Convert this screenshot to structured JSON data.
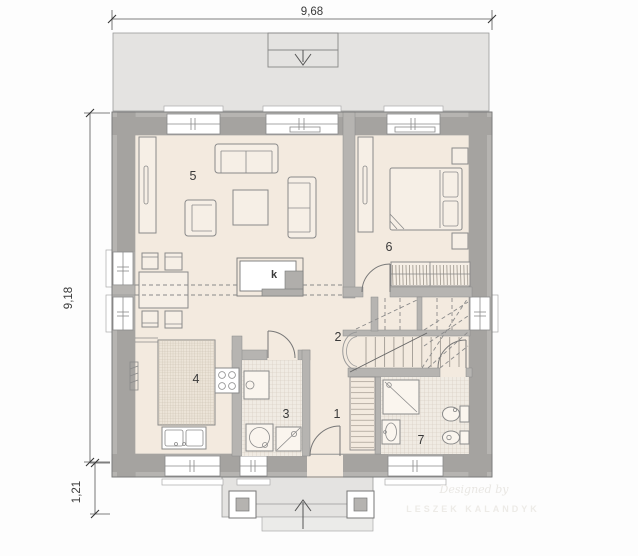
{
  "dimensions": {
    "top": "9,68",
    "left": "9,18",
    "porch_depth": "1,21"
  },
  "room_labels": {
    "hall": "1",
    "stairs": "2",
    "utility": "3",
    "kitchen": "4",
    "living_room": "5",
    "bedroom": "6",
    "bathroom": "7"
  },
  "fireplace": {
    "label": "k"
  },
  "watermark": {
    "line1": "Designed by",
    "line2": "LESZEK KALANDYK"
  },
  "colors": {
    "floor": "#f3eadf",
    "wall": "#b6b4b1",
    "terrace": "#e4e3e1",
    "label": "#3a3a3a"
  }
}
